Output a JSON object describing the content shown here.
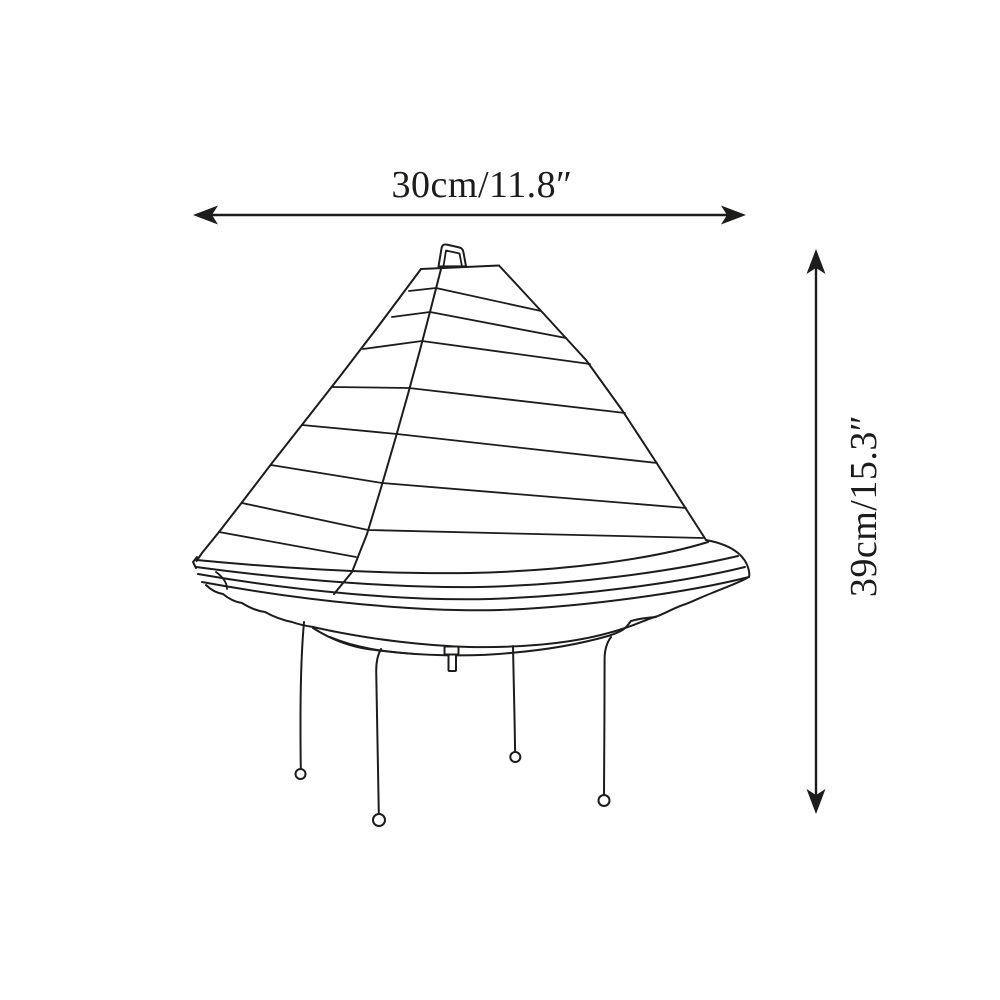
{
  "diagram": {
    "subject": "line drawing of a pyramid-shaped paper lantern table lamp with ruffled tiered base, pull switch and four thin wire legs with ball feet",
    "width_label": "30cm/11.8″",
    "height_label": "39cm/15.3″",
    "width_cm": 30,
    "width_in": 11.8,
    "height_cm": 39,
    "height_in": 15.3,
    "line_color": "#1c1c1b",
    "background_color": "#ffffff"
  }
}
